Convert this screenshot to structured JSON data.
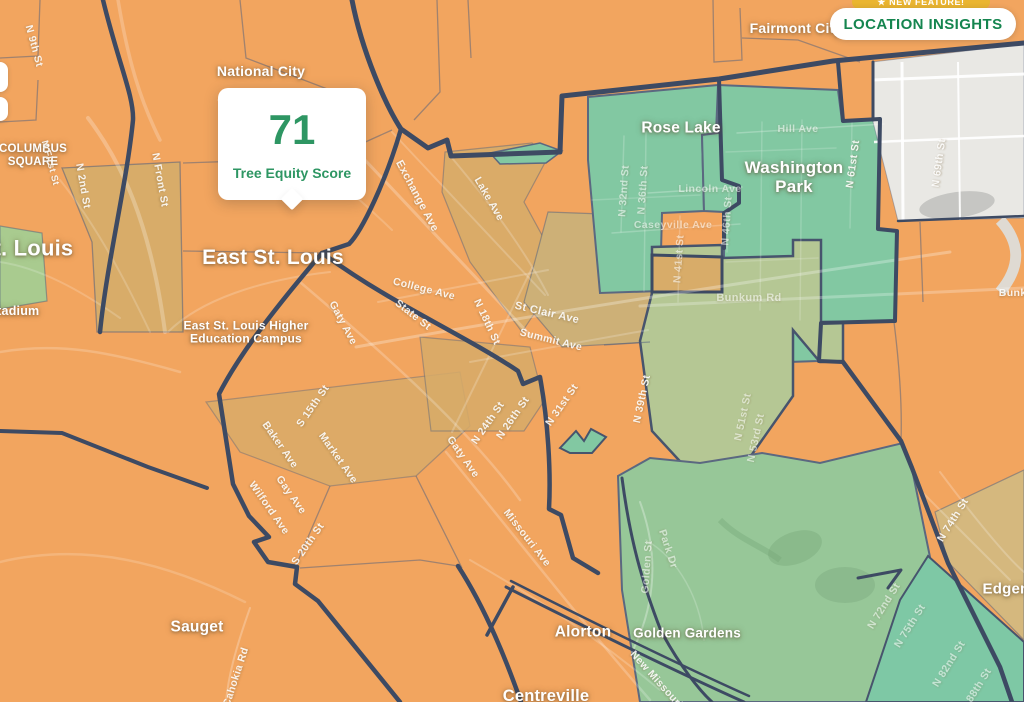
{
  "header": {
    "badge_label": "★ NEW FEATURE!",
    "button_label": "LOCATION INSIGHTS"
  },
  "popup": {
    "score": "71",
    "caption": "Tree Equity Score"
  },
  "colors": {
    "base_orange": "#F2A55F",
    "tan": "#D8AC69",
    "khaki": "#CDB077",
    "teal_green": "#82C8A2",
    "olive_green": "#B5C794",
    "park_green": "#97C798",
    "corner_teal": "#7EC8A5",
    "light_green": "#A9CB8F",
    "edge_tan": "#D5B87E",
    "gray_area": "#E9E8E4",
    "gray_blob": "#C6C6C3",
    "boundary_navy": "#3D4A63",
    "score_green": "#2E9663",
    "button_green": "#15854F",
    "badge_gold": "#EAB530"
  },
  "map": {
    "place_labels": [
      {
        "text": "National City",
        "x": 261,
        "y": 72,
        "size": 14
      },
      {
        "text": "East St. Louis",
        "x": 273,
        "y": 258,
        "size": 21
      },
      {
        "text": "St. Louis",
        "x": 26,
        "y": 249,
        "size": 22
      },
      {
        "lines": [
          "COLUMBUS",
          "SQUARE"
        ],
        "x": 33,
        "y": 156,
        "size": 11.5
      },
      {
        "text": "Stadium",
        "x": 14,
        "y": 311,
        "size": 12.5
      },
      {
        "lines": [
          "East St. Louis Higher",
          "Education Campus"
        ],
        "x": 246,
        "y": 333,
        "size": 12
      },
      {
        "text": "Fairmont City",
        "x": 796,
        "y": 29,
        "size": 14
      },
      {
        "text": "Rose Lake",
        "x": 681,
        "y": 128,
        "size": 15.5
      },
      {
        "lines": [
          "Washington",
          "Park"
        ],
        "x": 794,
        "y": 177,
        "size": 17
      },
      {
        "text": "Sauget",
        "x": 197,
        "y": 627,
        "size": 15.5
      },
      {
        "text": "Alorton",
        "x": 583,
        "y": 632,
        "size": 15.5
      },
      {
        "text": "Golden Gardens",
        "x": 687,
        "y": 633,
        "size": 13.5
      },
      {
        "text": "Centreville",
        "x": 546,
        "y": 696,
        "size": 16.5
      },
      {
        "text": "Edgemont",
        "x": 1020,
        "y": 590,
        "size": 15
      }
    ],
    "street_labels": [
      {
        "t": "N 9th St",
        "x": 34,
        "y": 46,
        "r": 75
      },
      {
        "t": "N First St",
        "x": 50,
        "y": 163,
        "r": 75,
        "s": 9.5
      },
      {
        "t": "N 2nd St",
        "x": 83,
        "y": 186,
        "r": 80
      },
      {
        "t": "N Front St",
        "x": 160,
        "y": 180,
        "r": 80
      },
      {
        "t": "Exchange Ave",
        "x": 417,
        "y": 196,
        "r": 62,
        "s": 11
      },
      {
        "t": "Lake Ave",
        "x": 489,
        "y": 199,
        "r": 60
      },
      {
        "t": "N 18th St",
        "x": 487,
        "y": 322,
        "r": 65
      },
      {
        "t": "College Ave",
        "x": 424,
        "y": 289,
        "r": 14
      },
      {
        "t": "State St",
        "x": 413,
        "y": 315,
        "r": 38
      },
      {
        "t": "St Clair Ave",
        "x": 547,
        "y": 313,
        "r": 13,
        "s": 11
      },
      {
        "t": "Summit Ave",
        "x": 551,
        "y": 340,
        "r": 14
      },
      {
        "t": "Gaty Ave",
        "x": 343,
        "y": 323,
        "r": 62
      },
      {
        "t": "Gaty Ave",
        "x": 463,
        "y": 457,
        "r": 55
      },
      {
        "t": "Baker Ave",
        "x": 280,
        "y": 445,
        "r": 55
      },
      {
        "t": "Market Ave",
        "x": 338,
        "y": 458,
        "r": 55
      },
      {
        "t": "S 15th St",
        "x": 313,
        "y": 406,
        "r": -55
      },
      {
        "t": "Gay Ave",
        "x": 291,
        "y": 495,
        "r": 55
      },
      {
        "t": "Wilford Ave",
        "x": 269,
        "y": 508,
        "r": 55
      },
      {
        "t": "S 20th St",
        "x": 308,
        "y": 544,
        "r": -55
      },
      {
        "t": "N 24th St",
        "x": 488,
        "y": 423,
        "r": -55
      },
      {
        "t": "N 26th St",
        "x": 513,
        "y": 418,
        "r": -55
      },
      {
        "t": "N 31st St",
        "x": 562,
        "y": 405,
        "r": -55
      },
      {
        "t": "Missouri Ave",
        "x": 527,
        "y": 538,
        "r": 52
      },
      {
        "t": "New Missouri Ave",
        "x": 664,
        "y": 688,
        "r": 48
      },
      {
        "t": "Cahokia Rd",
        "x": 236,
        "y": 677,
        "r": -72
      },
      {
        "t": "N 39th St",
        "x": 642,
        "y": 399,
        "r": -78
      },
      {
        "t": "N 51st St",
        "x": 743,
        "y": 417,
        "r": -78,
        "dim": true
      },
      {
        "t": "N 53rd St",
        "x": 756,
        "y": 438,
        "r": -78,
        "dim": true
      },
      {
        "t": "N 32nd St",
        "x": 624,
        "y": 191,
        "r": -86,
        "dim": true
      },
      {
        "t": "N 36th St",
        "x": 643,
        "y": 190,
        "r": -86,
        "dim": true
      },
      {
        "t": "Lincoln Ave",
        "x": 710,
        "y": 189,
        "r": 0,
        "dim": true
      },
      {
        "t": "Caseyville Ave",
        "x": 673,
        "y": 225,
        "r": 0,
        "dim": true
      },
      {
        "t": "N 41st St",
        "x": 679,
        "y": 259,
        "r": -86,
        "dim": true
      },
      {
        "t": "N 46th St",
        "x": 727,
        "y": 221,
        "r": -86,
        "dim": true
      },
      {
        "t": "Hill Ave",
        "x": 798,
        "y": 129,
        "r": 0,
        "dim": true
      },
      {
        "t": "N 61st St",
        "x": 853,
        "y": 164,
        "r": -82
      },
      {
        "t": "N 69th St",
        "x": 939,
        "y": 163,
        "r": -82
      },
      {
        "t": "Bunkum Rd",
        "x": 749,
        "y": 298,
        "r": 0,
        "dim": true,
        "s": 11
      },
      {
        "t": "Bunkum Rd",
        "x": 1030,
        "y": 293,
        "r": 0
      },
      {
        "t": "Park Dr",
        "x": 668,
        "y": 549,
        "r": 72,
        "dim": true
      },
      {
        "t": "Golden St",
        "x": 647,
        "y": 567,
        "r": -86,
        "dim": true
      },
      {
        "t": "N 72nd St",
        "x": 884,
        "y": 606,
        "r": -58,
        "dim": true
      },
      {
        "t": "N 75th St",
        "x": 910,
        "y": 626,
        "r": -58,
        "dim": true
      },
      {
        "t": "N 74th St",
        "x": 953,
        "y": 520,
        "r": -58
      },
      {
        "t": "N 82nd St",
        "x": 949,
        "y": 664,
        "r": -58,
        "dim": true
      },
      {
        "t": "N 88th St",
        "x": 976,
        "y": 690,
        "r": -58,
        "dim": true
      }
    ]
  }
}
